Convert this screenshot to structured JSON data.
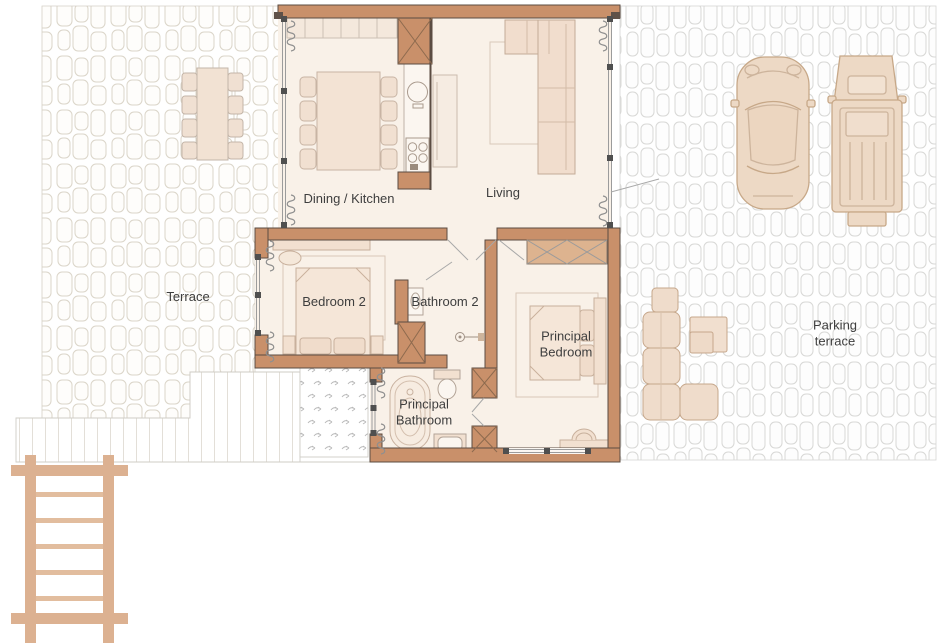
{
  "title": "Villa floor plan",
  "rooms": {
    "dining_kitchen": {
      "label": "Dining / Kitchen"
    },
    "living": {
      "label": "Living"
    },
    "bedroom_2": {
      "label": "Bedroom 2"
    },
    "bathroom_2": {
      "label": "Bathroom 2"
    },
    "principal_bedroom": {
      "label": "Principal Bedroom"
    },
    "principal_bathroom": {
      "label": "Principal Bathroom"
    }
  },
  "outdoor": {
    "terrace": {
      "label": "Terrace"
    },
    "parking_terrace": {
      "label": "Parking terrace"
    }
  },
  "objects": [
    "sports car",
    "pickup truck",
    "outdoor dining table with eight chairs",
    "indoor dining table with eight chairs",
    "kitchen counter with sink and hob",
    "corner sofa",
    "double bed",
    "wardrobe",
    "bathtub",
    "toilet",
    "washbasin",
    "shower",
    "outdoor lounge sofa",
    "coffee table",
    "wooden pergola",
    "decked steps",
    "planted patio"
  ],
  "colors": {
    "wall": "#c9906a",
    "wall_outline": "#5b4c42",
    "floor": "#f9f1e8",
    "furniture": "#f2e0d0",
    "furniture_outline": "#c8b09c",
    "outdoor_furniture": "#efdccb",
    "car_fill": "#edd9c5",
    "wood": "#dcb191",
    "stone_outline_terrace": "#dbd5c9",
    "stone_outline_parking": "#d8d8d6",
    "text": "#3e3e3e"
  }
}
